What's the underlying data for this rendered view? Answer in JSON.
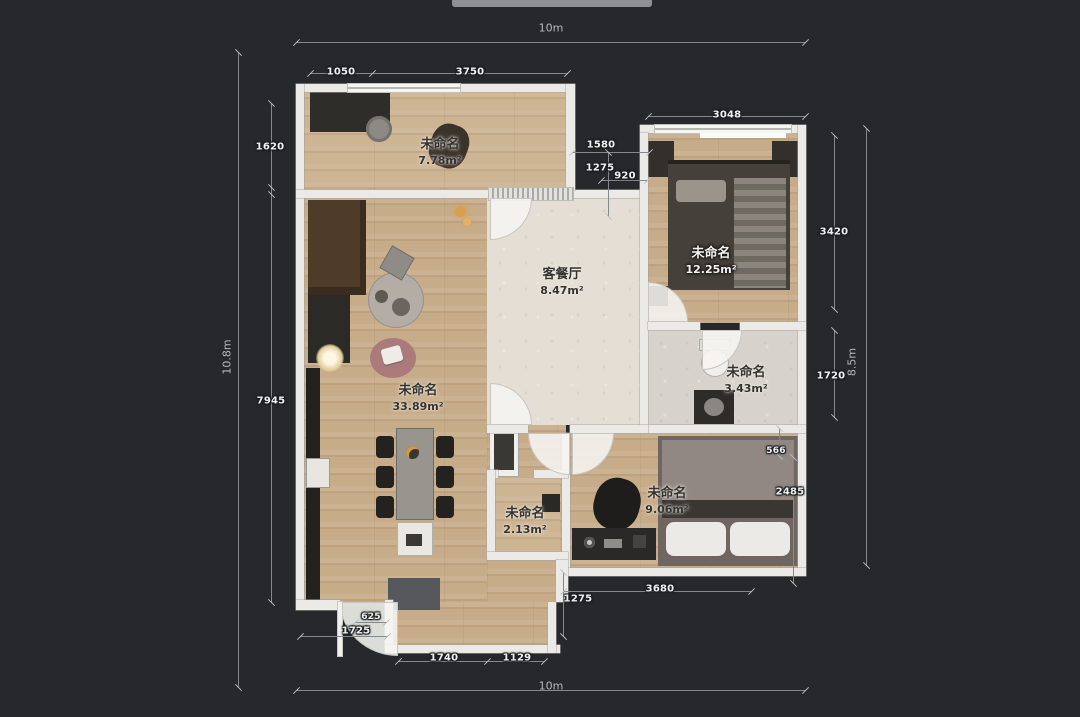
{
  "scale_labels": {
    "top": "10m",
    "bottom": "10m",
    "left": "10.8m",
    "right": "8.5m"
  },
  "dimensions": {
    "top_1050": "1050",
    "top_3750": "3750",
    "top_3048": "3048",
    "left_1620": "1620",
    "left_7945": "7945",
    "mid_1580": "1580",
    "mid_1275": "1275",
    "mid_920": "920",
    "right_3420": "3420",
    "right_1720": "1720",
    "right_566": "566",
    "right_2485": "2485",
    "bottom_625": "625",
    "bottom_1725": "1725",
    "bottom_1740": "1740",
    "bottom_1129": "1129",
    "bottom_1275": "1275",
    "bottom_3680": "3680"
  },
  "rooms": {
    "balcony_top": {
      "name": "未命名",
      "area": "7.78m²"
    },
    "living_dining": {
      "name": "客餐厅",
      "area": "8.47m²"
    },
    "bedroom_right": {
      "name": "未命名",
      "area": "12.25m²"
    },
    "bathroom": {
      "name": "未命名",
      "area": "3.43m²"
    },
    "main_area": {
      "name": "未命名",
      "area": "33.89m²"
    },
    "storage": {
      "name": "未命名",
      "area": "2.13m²"
    },
    "bedroom_bottom": {
      "name": "未命名",
      "area": "9.06m²"
    }
  },
  "colors": {
    "background": "#26282c",
    "wall": "#ebeae6",
    "wood_floor": "#c7ac8a",
    "tile_floor": "#e4ded4",
    "dimension_line": "#83888e",
    "dimension_text": "#eef0f2"
  }
}
